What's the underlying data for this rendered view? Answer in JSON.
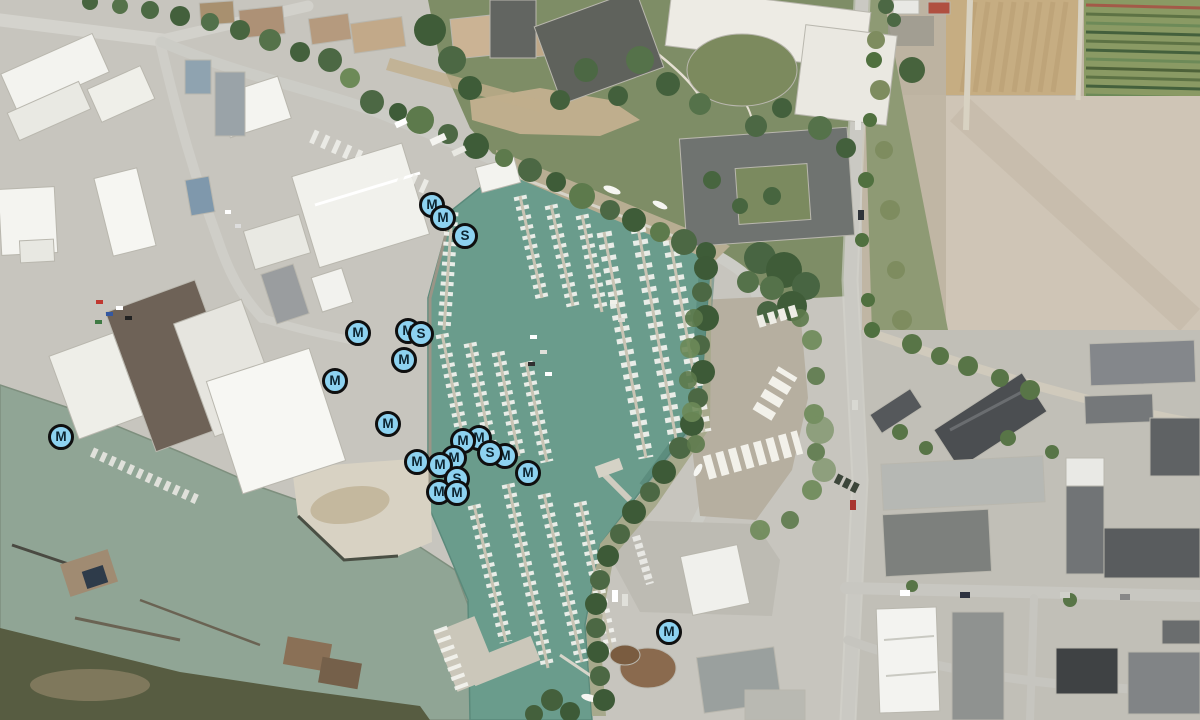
{
  "map": {
    "view": "satellite-aerial",
    "features": [
      "marina-basin",
      "river",
      "industrial-area",
      "farmland",
      "residential-area",
      "gravel-lot",
      "marsh"
    ]
  },
  "marker_style": {
    "fill": "#8dd2f0",
    "border": "#0f0f0f",
    "text": "#0c2430"
  },
  "colors": {
    "pavement": "#c7c5be",
    "river_water": "#90a595",
    "marina_water": "#6a9c8c",
    "marsh": "#575c41",
    "farmland": "#c6ad82",
    "trees": "#43603c",
    "white_building": "#f4f4f0",
    "road": "#ccccc6"
  },
  "markers": [
    {
      "label": "M",
      "x": 432,
      "y": 205
    },
    {
      "label": "M",
      "x": 443,
      "y": 218
    },
    {
      "label": "S",
      "x": 465,
      "y": 236
    },
    {
      "label": "M",
      "x": 358,
      "y": 333
    },
    {
      "label": "M",
      "x": 408,
      "y": 331
    },
    {
      "label": "S",
      "x": 421,
      "y": 334
    },
    {
      "label": "M",
      "x": 404,
      "y": 360
    },
    {
      "label": "M",
      "x": 335,
      "y": 381
    },
    {
      "label": "M",
      "x": 61,
      "y": 437
    },
    {
      "label": "M",
      "x": 388,
      "y": 424
    },
    {
      "label": "M",
      "x": 479,
      "y": 438
    },
    {
      "label": "M",
      "x": 463,
      "y": 441
    },
    {
      "label": "M",
      "x": 505,
      "y": 456
    },
    {
      "label": "S",
      "x": 490,
      "y": 453
    },
    {
      "label": "M",
      "x": 528,
      "y": 473
    },
    {
      "label": "M",
      "x": 454,
      "y": 458
    },
    {
      "label": "M",
      "x": 440,
      "y": 465
    },
    {
      "label": "M",
      "x": 417,
      "y": 462
    },
    {
      "label": "S",
      "x": 457,
      "y": 479
    },
    {
      "label": "M",
      "x": 439,
      "y": 492
    },
    {
      "label": "M",
      "x": 457,
      "y": 493
    },
    {
      "label": "M",
      "x": 669,
      "y": 632
    }
  ]
}
